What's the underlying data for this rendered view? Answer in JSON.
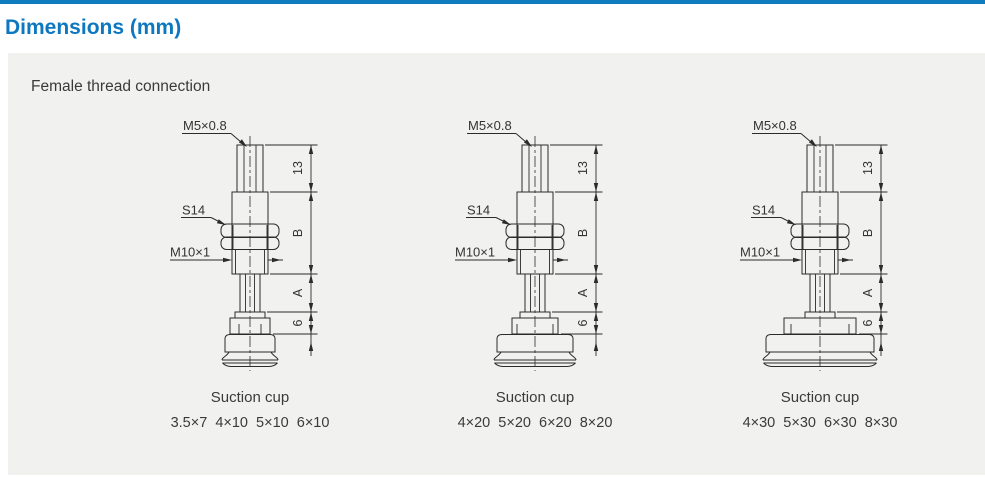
{
  "page": {
    "title": "Dimensions (mm)",
    "accent_color": "#0f7cc0",
    "panel_background": "#f1f2f0",
    "drawing_line_color": "#2b2b2b"
  },
  "panel": {
    "heading": "Female thread connection"
  },
  "shared_labels": {
    "thread_top": "M5×0.8",
    "wrench_flat": "S14",
    "thread_bottom": "M10×1",
    "dim_top": "13",
    "dim_body": "B",
    "dim_shaft": "A",
    "dim_cup_holder": "6",
    "caption": "Suction cup"
  },
  "diagrams": [
    {
      "cup_size": "small",
      "sizes": "3.5×7  4×10  5×10  6×10"
    },
    {
      "cup_size": "medium",
      "sizes": "4×20  5×20  6×20  8×20"
    },
    {
      "cup_size": "large",
      "sizes": "4×30  5×30  6×30  8×30"
    }
  ]
}
